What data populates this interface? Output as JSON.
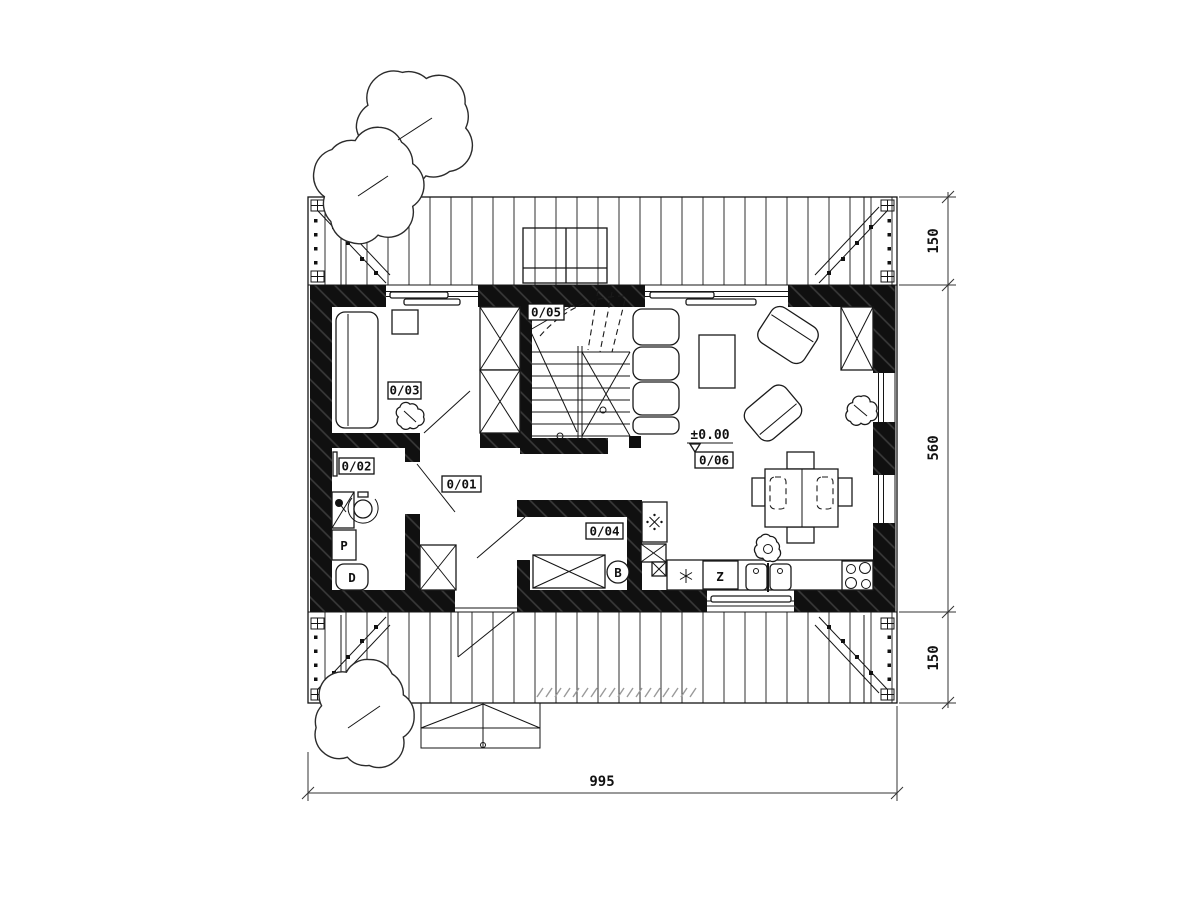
{
  "plan": {
    "rooms": {
      "hall": "0/01",
      "bath": "0/02",
      "bedroom": "0/03",
      "utility": "0/04",
      "stairs": "0/05",
      "living": "0/06"
    },
    "fixtures": {
      "washer": "P",
      "wc": "D",
      "dishwasher": "Z",
      "boiler": "B"
    },
    "level": "±0.00",
    "dims": {
      "width": "995",
      "overhang_top": "150",
      "depth": "560",
      "overhang_bottom": "150"
    }
  }
}
